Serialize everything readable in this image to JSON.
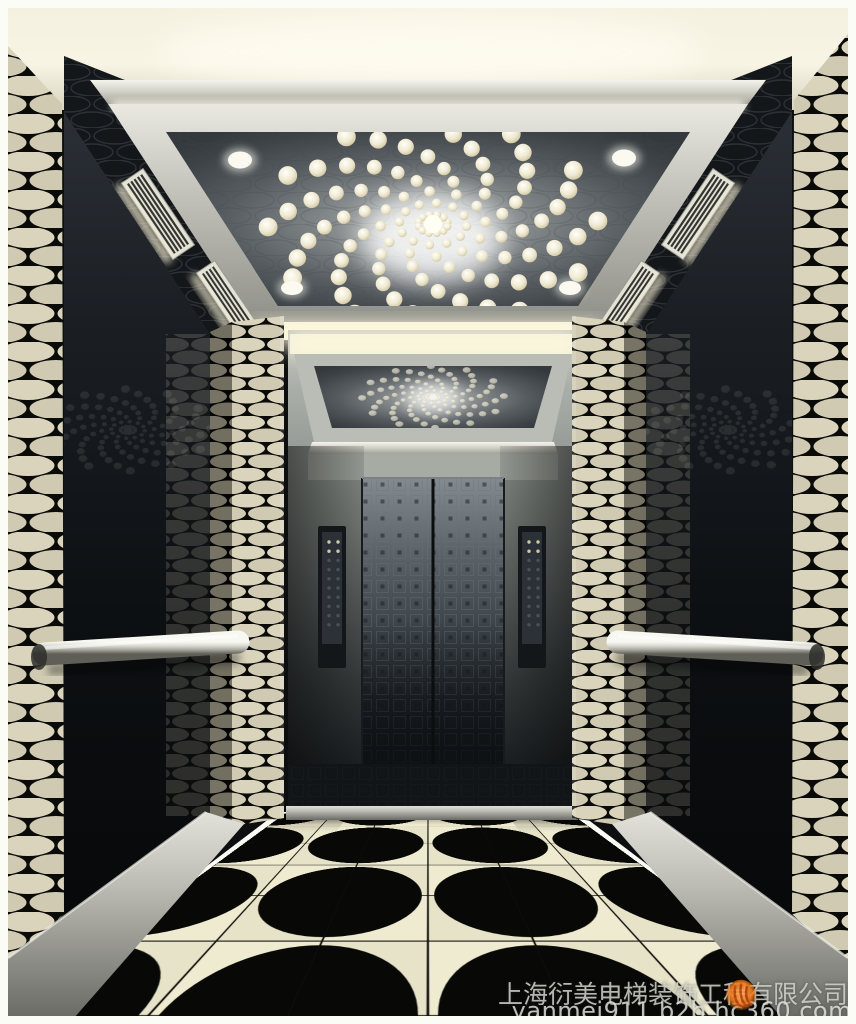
{
  "watermark": {
    "company": "上海衍美电梯装饰工程有限公司",
    "url": "yanmei911.b2b.hc360.com",
    "logo_name": "hc360-flame-logo"
  },
  "scene": {
    "description": "3D rendering of an elevator cab interior: spiral chandelier of round lights on a dark mirrored ceiling panel, brushed steel frame and cove lighting, black-and-cream woven patterned pillars and side walls, dark mirror wall panels with steel handrails, etched stainless center doors with control panels, and a glossy black-and-cream quarter-circle fan tiled floor.",
    "chandelier": {
      "arms": 12,
      "lights_per_arm": 9
    },
    "downlights": {
      "panel_corner": 4,
      "outer_ceiling": 2
    },
    "vents": 4,
    "handrails": 2,
    "cop_panels": 2,
    "floor": {
      "cols": 6,
      "rows": 6,
      "tile": 140
    },
    "colors": {
      "frame_white": "#fcfcf7",
      "ceiling_cream": "#f4f1e1",
      "steel_silver": "#c9c9c1",
      "ceiling_panel_dark": "#43484c",
      "mirror_wall_dark": "#0d1013",
      "pattern_cream": "#d9d4bb",
      "pattern_black": "#0a0a08",
      "door_steel": "#3c4348",
      "floor_cream": "#ebe7cd",
      "floor_black": "#080806",
      "watermark_orange": "#ef7b1e"
    }
  }
}
